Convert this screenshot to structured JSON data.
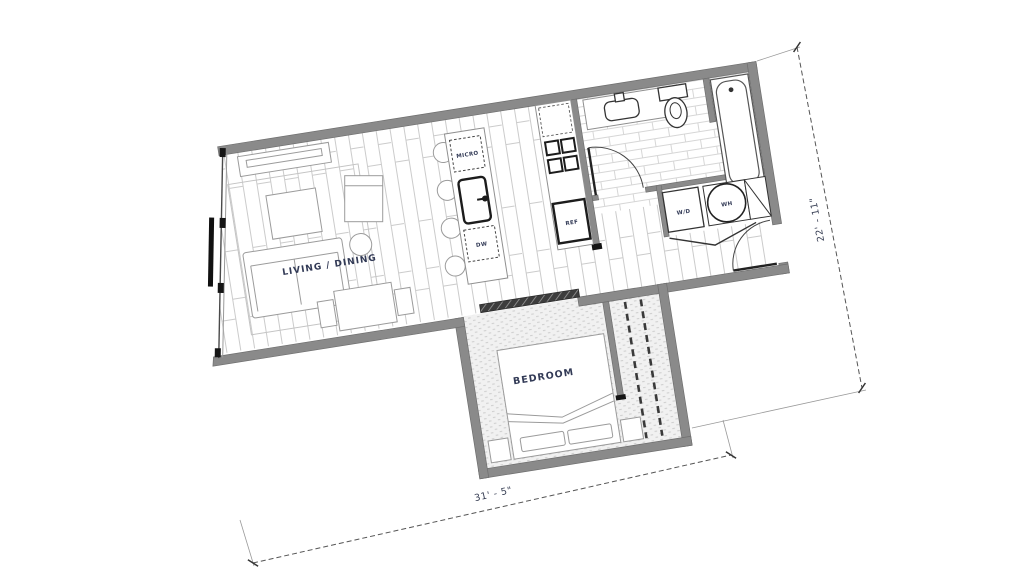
{
  "floor_plan": {
    "rooms": {
      "living_dining": "LIVING / DINING",
      "bedroom": "BEDROOM"
    },
    "fixtures": {
      "micro": "MICRO",
      "dw": "DW",
      "ref": "REF",
      "wd": "W/D",
      "wh": "WH"
    },
    "dimensions": {
      "right": "22' - 11\"",
      "bottom": "31' - 5\""
    },
    "colors": {
      "wall": "#8a8a8a",
      "floor_line": "#cbcbcb",
      "label_text": "#323a56",
      "fixture_bold": "#1c1c1c"
    }
  }
}
